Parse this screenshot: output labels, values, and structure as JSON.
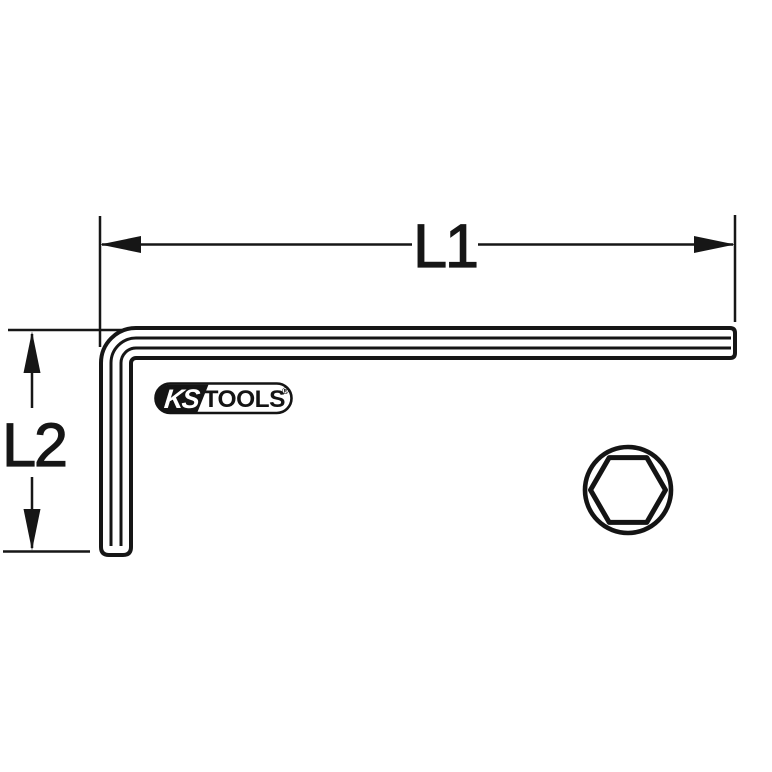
{
  "canvas": {
    "background": "#ffffff",
    "line_color": "#161616",
    "alt": "Technical outline drawing of an offset L-shaped hex key (Allen key) with dimension arrows and hexagonal cross-section"
  },
  "drawing": {
    "dimension_l1": {
      "label": "L1"
    },
    "dimension_l2": {
      "label": "L2"
    },
    "logo": {
      "ks": "KS",
      "tools": "TOOLS",
      "registered": "®"
    },
    "cross_section_icon": "hexagon-in-circle"
  }
}
